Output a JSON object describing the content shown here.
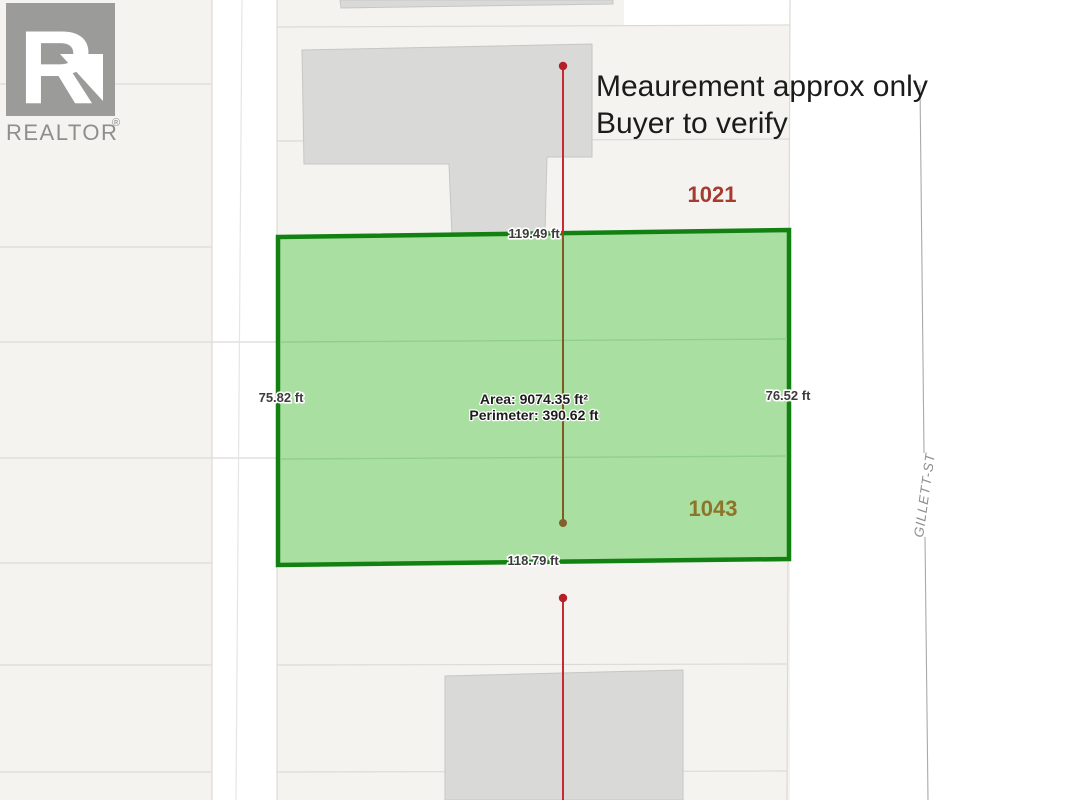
{
  "branding": {
    "logo_letter": "R",
    "logo_text": "REALTOR",
    "registered": "®"
  },
  "disclaimer": {
    "line1": "Meaurement approx only",
    "line2": "Buyer to verify"
  },
  "subject_lot": {
    "area": "Area: 9074.35 ft²",
    "perimeter": "Perimeter: 390.62 ft",
    "edge_top": "119.49 ft",
    "edge_bottom": "118.79 ft",
    "edge_left": "75.82 ft",
    "edge_right": "76.52 ft",
    "fill": "#a9dfa0",
    "border": "#128112"
  },
  "adjacent_lots": {
    "north_label": "1021",
    "north_color": "#a63b30",
    "south_label": "1043",
    "south_color": "#8d7428"
  },
  "street": {
    "name": "GILLETT-ST",
    "color": "#8e8e8c"
  },
  "map_colors": {
    "parcel_fill": "#f4f3f0",
    "parcel_line": "#dcdad6",
    "building": "#d9d9d7",
    "survey_red": "#c62a33",
    "survey_olive": "#7d5a26",
    "survey_dot_red": "#b51f28",
    "survey_dot_olive": "#82602c"
  }
}
